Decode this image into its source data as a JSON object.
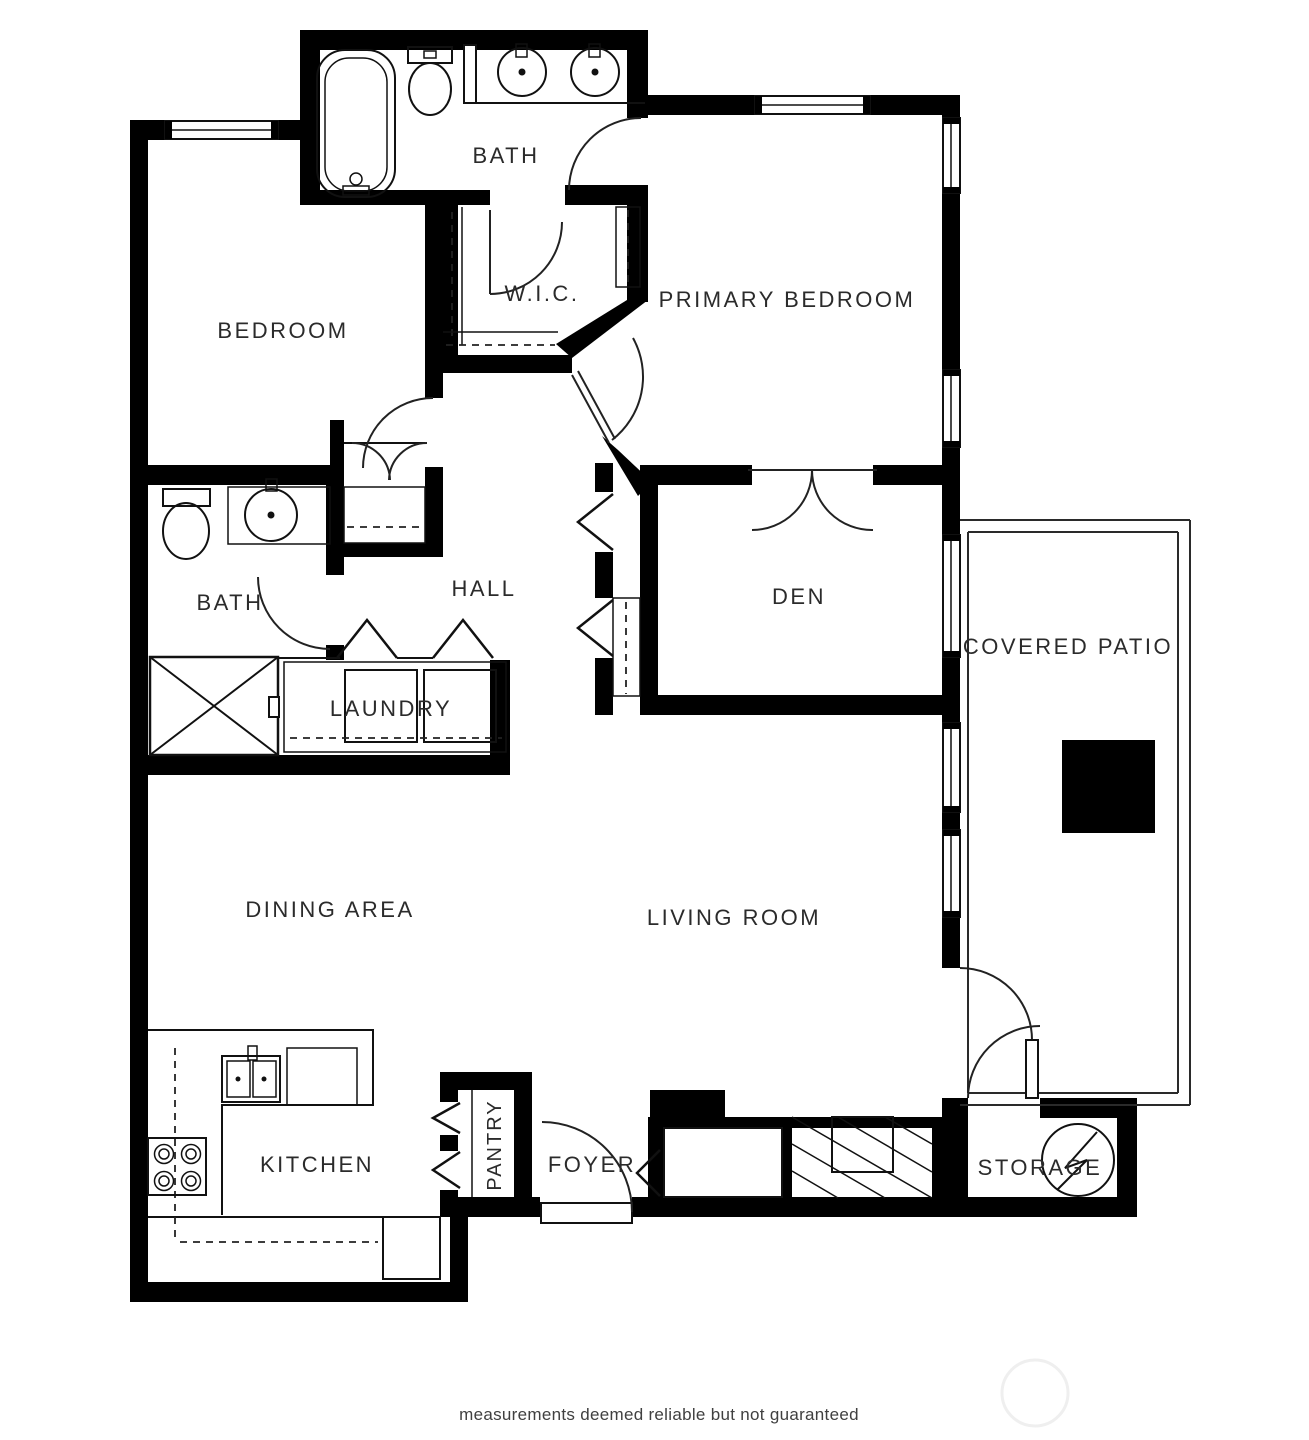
{
  "colors": {
    "wall": "#000000",
    "line": "#111111",
    "label": "#2b2b2b",
    "disclaimer_text_color": "#404040"
  },
  "labels": {
    "bath_top": "BATH",
    "bedroom": "BEDROOM",
    "wic": "W.I.C.",
    "primary_bedroom": "PRIMARY BEDROOM",
    "bath_hall": "BATH",
    "hall": "HALL",
    "den": "DEN",
    "laundry": "LAUNDRY",
    "covered_patio": "COVERED PATIO",
    "dining_area": "DINING AREA",
    "living_room": "LIVING ROOM",
    "kitchen": "KITCHEN",
    "pantry": "PANTRY",
    "foyer": "FOYER",
    "storage": "STORAGE"
  },
  "footer": {
    "disclaimer": "measurements deemed reliable but not guaranteed"
  }
}
